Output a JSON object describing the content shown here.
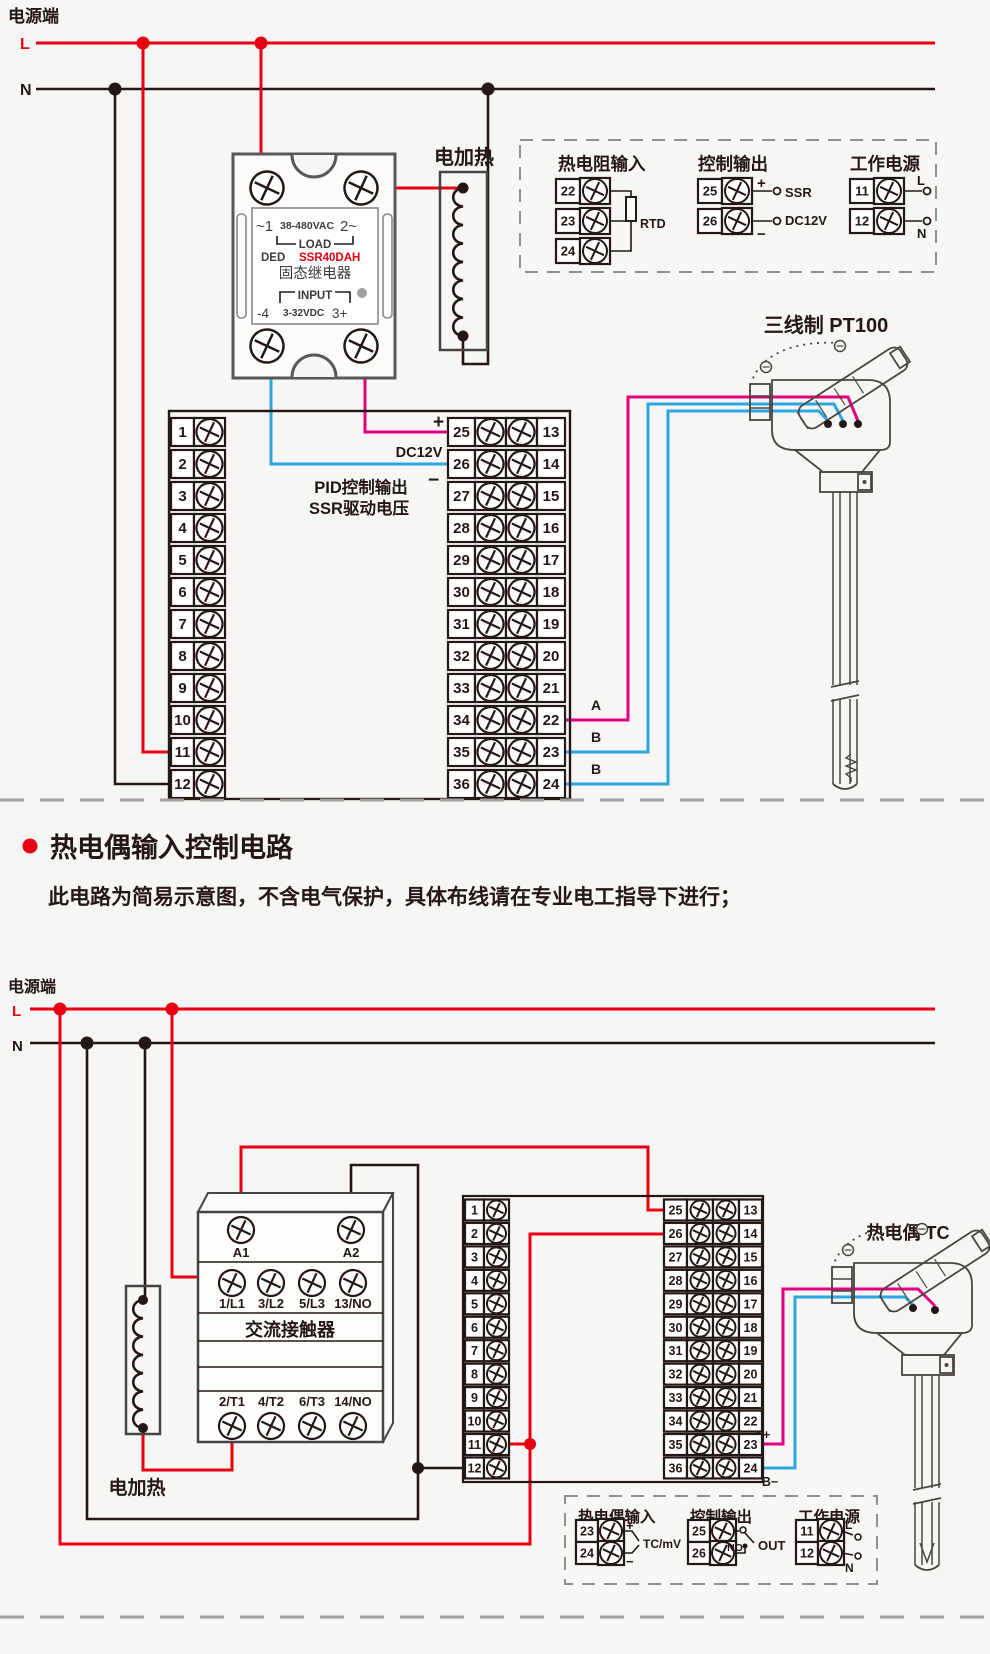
{
  "colors": {
    "red": "#e60012",
    "magenta": "#e3007f",
    "blue": "#2ea7e0",
    "dark": "#231815",
    "gray": "#595757",
    "bg": "#f6f6f4"
  },
  "top": {
    "power_label": "电源端",
    "l": "L",
    "n": "N",
    "ssr": {
      "t1a": "~1",
      "t1b": "38-480VAC",
      "t1c": "2~",
      "load": "LOAD",
      "ded": "DED",
      "model": "SSR40DAH",
      "name": "固态继电器",
      "input": "INPUT",
      "b1": "-4",
      "b2": "3-32VDC",
      "b3": "3+"
    },
    "heater_label": "电加热",
    "inset": {
      "rtd_title": "热电阻输入",
      "rtd_terms": [
        "22",
        "23",
        "24"
      ],
      "rtd": "RTD",
      "out_title": "控制输出",
      "out_terms": [
        "25",
        "26"
      ],
      "plus": "+",
      "minus": "−",
      "ssr": "SSR",
      "dc12v": "DC12V",
      "pwr_title": "工作电源",
      "pwr_terms": [
        "11",
        "12"
      ],
      "l": "L",
      "n": "N"
    },
    "block": {
      "left": [
        "1",
        "2",
        "3",
        "4",
        "5",
        "6",
        "7",
        "8",
        "9",
        "10",
        "11",
        "12"
      ],
      "mid": [
        "25",
        "26",
        "27",
        "28",
        "29",
        "30",
        "31",
        "32",
        "33",
        "34",
        "35",
        "36"
      ],
      "right": [
        "13",
        "14",
        "15",
        "16",
        "17",
        "18",
        "19",
        "20",
        "21",
        "22",
        "23",
        "24"
      ],
      "plus": "+",
      "dc12v": "DC12V",
      "minus": "−",
      "pid1": "PID控制输出",
      "pid2": "SSR驱动电压",
      "a": "A",
      "b1": "B",
      "b2": "B"
    },
    "sensor_label": "三线制 PT100"
  },
  "section2": {
    "title": "热电偶输入控制电路",
    "subtitle": "此电路为简易示意图，不含电气保护，具体布线请在专业电工指导下进行；"
  },
  "bottom": {
    "power_label": "电源端",
    "l": "L",
    "n": "N",
    "contactor": {
      "a1": "A1",
      "a2": "A2",
      "top_row": [
        "1/L1",
        "3/L2",
        "5/L3",
        "13/NO"
      ],
      "name": "交流接触器",
      "bottom_row": [
        "2/T1",
        "4/T2",
        "6/T3",
        "14/NO"
      ]
    },
    "heater_label": "电加热",
    "block": {
      "left": [
        "1",
        "2",
        "3",
        "4",
        "5",
        "6",
        "7",
        "8",
        "9",
        "10",
        "11",
        "12"
      ],
      "mid": [
        "25",
        "26",
        "27",
        "28",
        "29",
        "30",
        "31",
        "32",
        "33",
        "34",
        "35",
        "36"
      ],
      "right": [
        "13",
        "14",
        "15",
        "16",
        "17",
        "18",
        "19",
        "20",
        "21",
        "22",
        "23",
        "24"
      ],
      "a_plus": "A+",
      "b_minus": "B−"
    },
    "sensor_label": "热电偶 TC",
    "inset": {
      "tc_title": "热电偶输入",
      "tc_terms": [
        "23",
        "24"
      ],
      "plus": "+",
      "minus": "−",
      "tc": "TC/mV",
      "out_title": "控制输出",
      "out_terms": [
        "25",
        "26"
      ],
      "no": "NO",
      "out": "OUT",
      "pwr_title": "工作电源",
      "pwr_terms": [
        "11",
        "12"
      ],
      "l": "L",
      "n": "N"
    }
  }
}
